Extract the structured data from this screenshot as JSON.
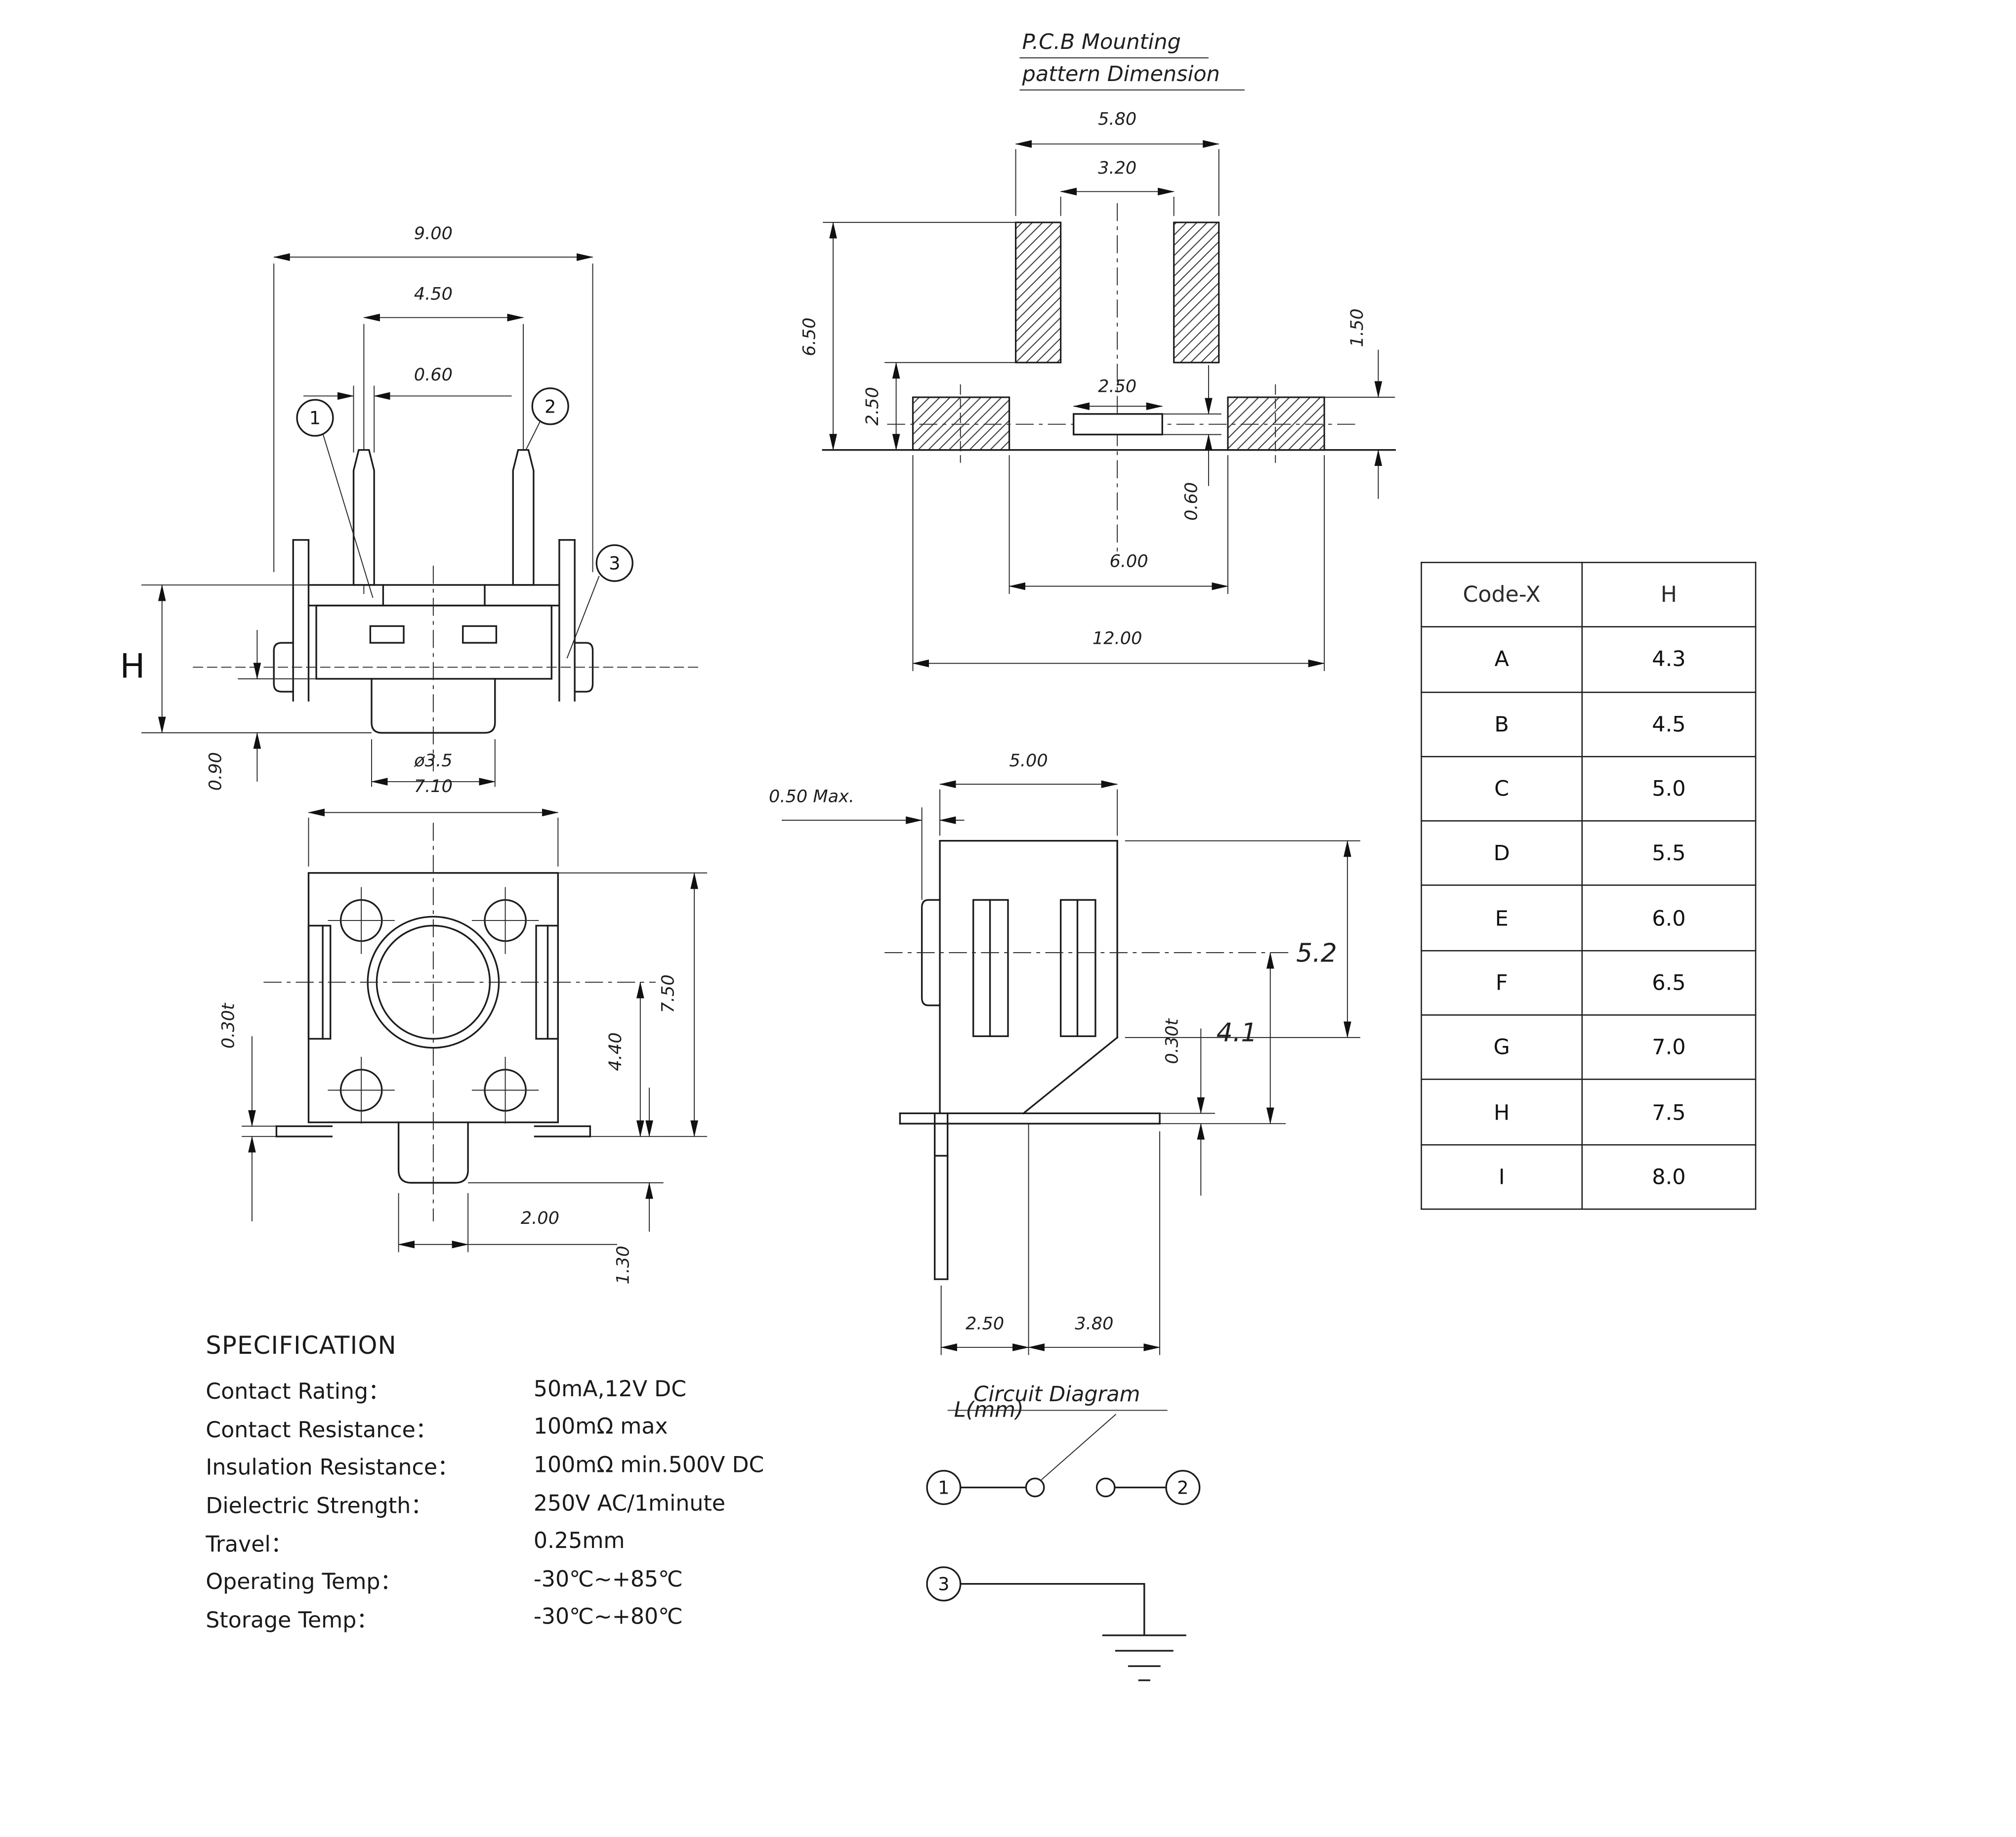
{
  "colors": {
    "line": "#1c1c1c",
    "background": "#ffffff"
  },
  "drawing": {
    "front_view": {
      "dim_overall_width": "9.00",
      "dim_pin_pitch": "4.50",
      "dim_pin_width": "0.60",
      "dim_height": "H",
      "dim_stem_protrusion": "0.90",
      "dim_stem_diameter": "ø3.5",
      "terminal_1": "1",
      "terminal_2": "2",
      "terminal_3": "3"
    },
    "pcb_pattern": {
      "title_line1": "P.C.B Mounting",
      "title_line2": "pattern Dimension",
      "dim_pad_span_outer": "5.80",
      "dim_pad_span_inner": "3.20",
      "dim_overall_height": "6.50",
      "dim_lower_gap": "2.50",
      "dim_pad_height": "1.50",
      "dim_slot_width": "2.50",
      "dim_slot_height": "0.60",
      "dim_lower_span_inner": "6.00",
      "dim_lower_span_outer": "12.00"
    },
    "top_view": {
      "dim_body_width": "7.10",
      "dim_metal_thickness": "0.30t",
      "dim_body_height": "7.50",
      "dim_center_height": "4.40",
      "dim_tab_width": "2.00",
      "dim_tab_protrusion": "1.30"
    },
    "side_view": {
      "dim_body_depth": "5.00",
      "dim_cap_protrusion": "0.50 Max.",
      "dim_total_height": "5.2",
      "dim_center_height": "4.1",
      "dim_metal_thickness": "0.30t",
      "dim_pin_offset": "2.50",
      "dim_foot_length": "3.80",
      "unit_label": "L(mm)"
    }
  },
  "circuit": {
    "title": "Circuit Diagram",
    "terminal_1": "1",
    "terminal_2": "2",
    "terminal_3": "3"
  },
  "table": {
    "headers": [
      "Code-X",
      "H"
    ],
    "rows": [
      [
        "A",
        "4.3"
      ],
      [
        "B",
        "4.5"
      ],
      [
        "C",
        "5.0"
      ],
      [
        "D",
        "5.5"
      ],
      [
        "E",
        "6.0"
      ],
      [
        "F",
        "6.5"
      ],
      [
        "G",
        "7.0"
      ],
      [
        "H",
        "7.5"
      ],
      [
        "I",
        "8.0"
      ]
    ]
  },
  "spec": {
    "title": "SPECIFICATION",
    "rows": [
      {
        "label": "Contact Rating：",
        "value": "50mA,12V DC"
      },
      {
        "label": "Contact Resistance：",
        "value": "100mΩ max"
      },
      {
        "label": "Insulation Resistance：",
        "value": "100mΩ min.500V DC"
      },
      {
        "label": "Dielectric Strength：",
        "value": "250V AC/1minute"
      },
      {
        "label": "Travel：",
        "value": "0.25mm"
      },
      {
        "label": "Operating Temp：",
        "value": "-30℃~+85℃"
      },
      {
        "label": "Storage Temp：",
        "value": "-30℃~+80℃"
      }
    ]
  }
}
